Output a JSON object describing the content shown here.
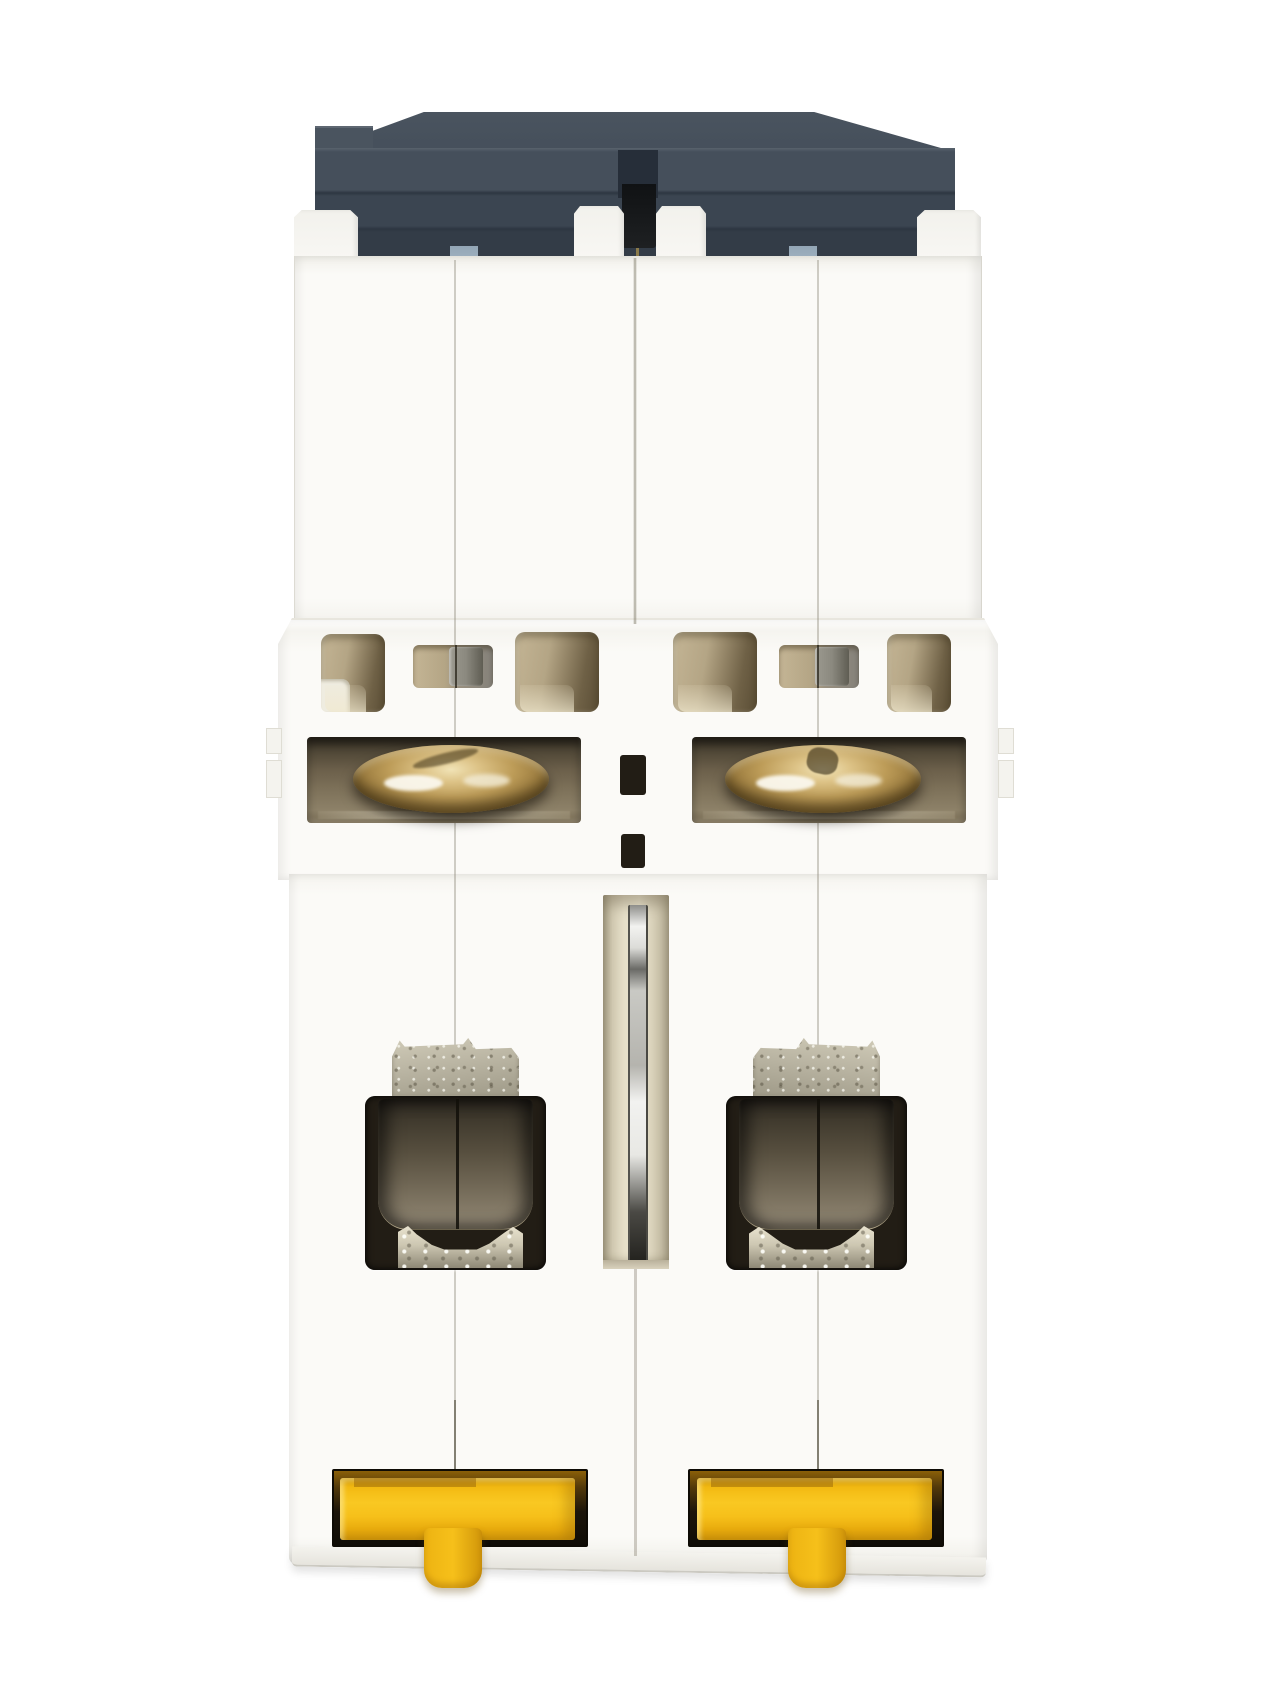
{
  "scene": {
    "type": "product-photograph",
    "subject": "2-pole miniature circuit breaker (MCB), viewed from the bottom / DIN-rail side",
    "orientation": "vertical, dark switch cap at top, yellow DIN-rail sliders at bottom",
    "modules": 2,
    "text_visible": "none"
  },
  "colors": {
    "bg": "#ffffff",
    "body": "#fbfaf7",
    "edge": "#dddbd3",
    "cap-hi": "#4a545f",
    "cap": "#454f5b",
    "cap-mid": "#3b4551",
    "cap-dark": "#333c47",
    "cap-darkest": "#2d3641",
    "black-tab": "#101214",
    "blue-tab-1": "#93a6b6",
    "blue-tab-2": "#aec0cd",
    "vent-1": "#c4b595",
    "vent-2": "#b4a585",
    "vent-3": "#6f6146",
    "vent-ledge": "#efece0",
    "term-1": "#352e23",
    "term-2": "#6b5f4a",
    "term-3": "#8d8168",
    "brass-hi": "#f1e3b6",
    "brass-1": "#ddc387",
    "brass-2": "#bd9c58",
    "brass-3": "#97783c",
    "brass-4": "#6d5528",
    "steel-1": "#d0cbb8",
    "steel-2": "#9c9785",
    "frame": "#221d15",
    "win-1": "#2c2720",
    "win-2": "#938977",
    "slot-1": "#d3cbb3",
    "slot-2": "#e6dfc8",
    "pin-1": "#f2f2f0",
    "pin-2": "#4a4944",
    "strip-1": "#e9e3cf",
    "strip-2": "#a59f8c",
    "yellow-1": "#f9c822",
    "yellow-2": "#f6c01a",
    "yellow-3": "#d1960a",
    "amber": "#8a5f08",
    "recess": "#0f0c06"
  },
  "parts": {
    "cap": "dark charcoal housing cap with stepped ridges",
    "toggle_notch": "black toggle-linkage tab recessed at cap center",
    "marker_tabs": "two small blue-grey tabs on cap underside",
    "upper_case": "plain white moulded case, two poles joined with center seam",
    "vent_row": "six ventilation openings with beige interior and grey coil visible",
    "screw_terminals": "two brass terminal screws in dark recesses",
    "center_pin": "chrome link pin in central slot between poles",
    "lower_cages": "two terminal cages with galvanized clamp and smoky window",
    "din_clips": "two yellow DIN-rail slider clips with release tabs",
    "bottom_face": "slightly slanted bottom edge with soft shadow"
  }
}
